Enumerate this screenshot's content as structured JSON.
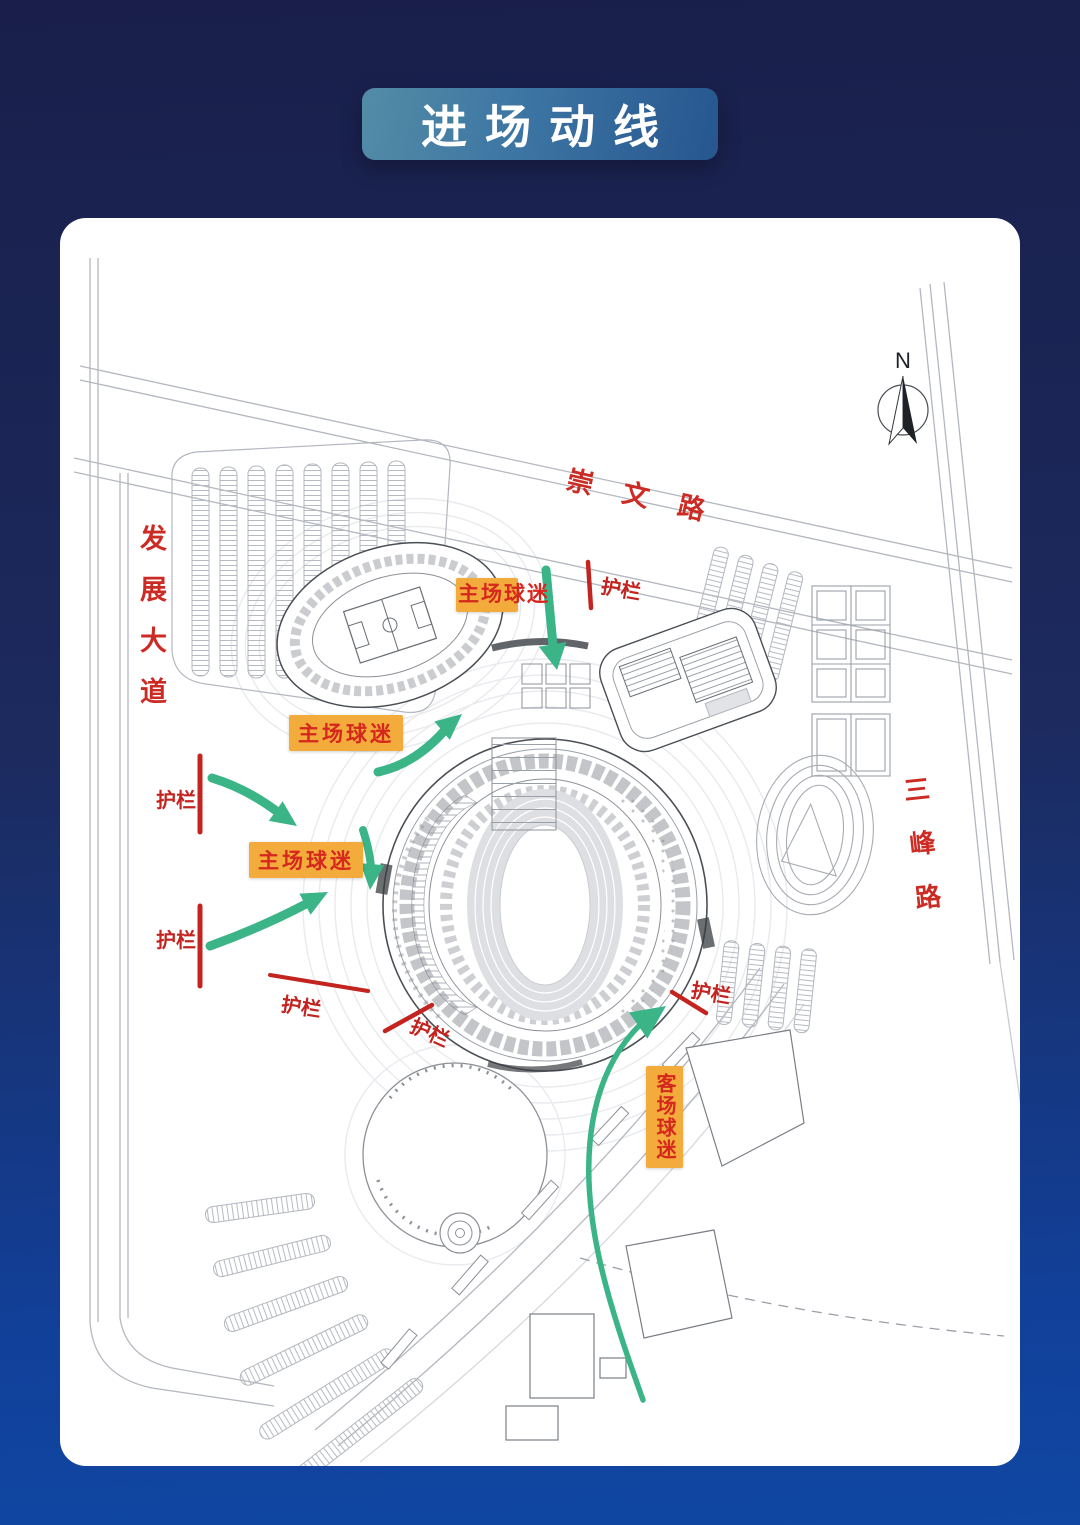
{
  "title": {
    "text": "进场动线"
  },
  "map": {
    "north_label": "N",
    "roads": {
      "chongwen": "崇文路",
      "fazhan": "发展大道",
      "sanfeng": "三峰路"
    },
    "badges": {
      "home_top": "主场球迷",
      "home_mid": "主场球迷",
      "home_left": "主场球迷",
      "away": "客场球迷"
    },
    "barriers": [
      {
        "label": "护栏"
      },
      {
        "label": "护栏"
      },
      {
        "label": "护栏"
      },
      {
        "label": "护栏"
      },
      {
        "label": "护栏"
      },
      {
        "label": "护栏"
      }
    ]
  },
  "colors": {
    "background_top": "#191f4a",
    "background_bottom": "#0f47a3",
    "title_pill": "#3c75a3",
    "card": "#ffffff",
    "flow_green": "#3bb488",
    "barrier_red": "#c42420",
    "badge_bg": "#f3ab3c",
    "badge_text": "#d5271d",
    "road_label_red": "#cc2b24",
    "plan_line": "#8c9097"
  }
}
